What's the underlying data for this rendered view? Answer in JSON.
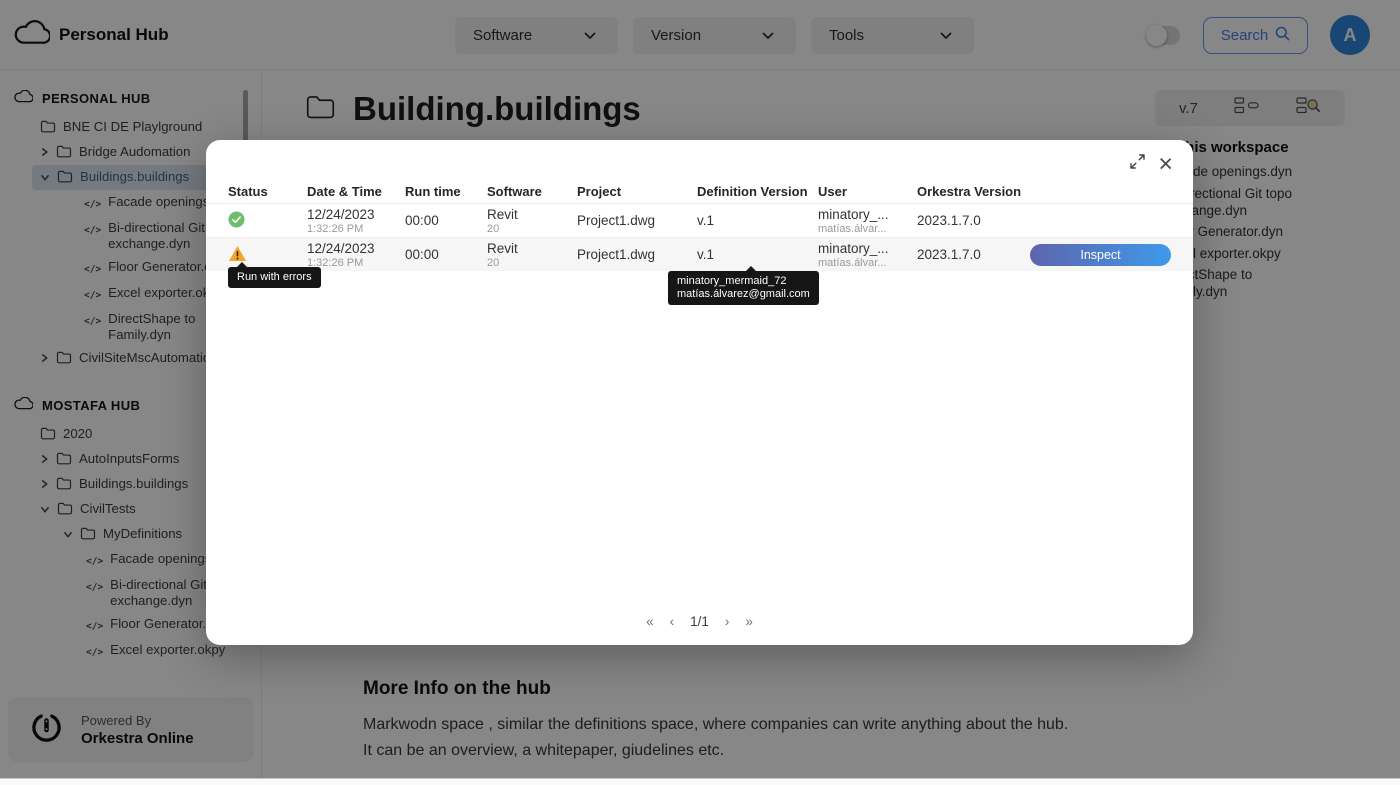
{
  "header": {
    "app_title": "Personal Hub",
    "dropdowns": [
      {
        "label": "Software"
      },
      {
        "label": "Version"
      },
      {
        "label": "Tools"
      }
    ],
    "search_label": "Search",
    "avatar_initial": "A"
  },
  "sidebar": {
    "hubs": [
      {
        "name": "PERSONAL HUB",
        "items": [
          {
            "indent": 1,
            "icon": "folder",
            "label": "BNE CI DE Playlground"
          },
          {
            "indent": 1,
            "chevron": "right",
            "icon": "folder",
            "label": "Bridge Audomation"
          },
          {
            "indent": 1,
            "chevron": "down",
            "icon": "folder",
            "label": "Buildings.buildings",
            "selected": true
          },
          {
            "indent": 2,
            "icon": "code",
            "label": "Facade openings.dyn"
          },
          {
            "indent": 2,
            "icon": "code",
            "label": "Bi-directional Git topo exchange.dyn"
          },
          {
            "indent": 2,
            "icon": "code",
            "label": "Floor Generator.dyn"
          },
          {
            "indent": 2,
            "icon": "code",
            "label": "Excel exporter.okpy"
          },
          {
            "indent": 2,
            "icon": "code",
            "label": "DirectShape to Family.dyn"
          },
          {
            "indent": 1,
            "chevron": "right",
            "icon": "folder",
            "label": "CivilSiteMscAutomation"
          }
        ]
      },
      {
        "name": "MOSTAFA HUB",
        "items": [
          {
            "indent": 1,
            "icon": "folder",
            "label": "2020"
          },
          {
            "indent": 1,
            "chevron": "right",
            "icon": "folder",
            "label": "AutoInputsForms"
          },
          {
            "indent": 1,
            "chevron": "right",
            "icon": "folder",
            "label": "Buildings.buildings"
          },
          {
            "indent": 1,
            "chevron": "down",
            "icon": "folder",
            "label": "CivilTests"
          },
          {
            "indent": 2,
            "chevron": "down",
            "icon": "folder",
            "label": "MyDefinitions"
          },
          {
            "indent": 3,
            "icon": "code",
            "label": "Facade openings.dyn"
          },
          {
            "indent": 3,
            "icon": "code",
            "label": "Bi-directional Git topo exchange.dyn"
          },
          {
            "indent": 3,
            "icon": "code",
            "label": "Floor Generator.dyn"
          },
          {
            "indent": 3,
            "icon": "code",
            "label": "Excel exporter.okpy"
          },
          {
            "indent": 3,
            "icon": "code",
            "label": "DirectShape to Family.dyn"
          }
        ]
      }
    ],
    "footer": {
      "powered_by": "Powered By",
      "brand": "Orkestra Online"
    }
  },
  "main": {
    "page_title": "Building.buildings",
    "toolbar": {
      "version_label": "v.7"
    },
    "workspace_panel": {
      "heading": "Definitions in this workspace",
      "items": [
        "Facade openings.dyn",
        "Bi-directional Git topo exchange.dyn",
        "Floor Generator.dyn",
        "Excel exporter.okpy",
        "DirectShape to Family.dyn"
      ]
    },
    "more_info": {
      "heading": "More Info on the hub",
      "body": "Markwodn space , similar the definitions space, where companies can write anything about the hub. It can be an overview, a whitepaper, giudelines etc."
    }
  },
  "modal": {
    "columns": [
      "Status",
      "Date & Time",
      "Run time",
      "Software",
      "Project",
      "Definition Version",
      "User",
      "Orkestra Version"
    ],
    "rows": [
      {
        "status": "success",
        "date": "12/24/2023",
        "time": "1:32:26 PM",
        "run_time": "00:00",
        "software": "Revit",
        "software_version": "20",
        "project": "Project1.dwg",
        "definition_version": "v.1",
        "user": "minatory_...",
        "user_email": "matías.álvar...",
        "orkestra_version": "2023.1.7.0"
      },
      {
        "status": "warning",
        "date": "12/24/2023",
        "time": "1:32:26 PM",
        "run_time": "00:00",
        "software": "Revit",
        "software_version": "20",
        "project": "Project1.dwg",
        "definition_version": "v.1",
        "user": "minatory_...",
        "user_email": "matías.álvar...",
        "orkestra_version": "2023.1.7.0",
        "action": "Inspect"
      }
    ],
    "tooltips": {
      "status_tooltip": "Run with errors",
      "user_tooltip_name": "minatory_mermaid_72",
      "user_tooltip_email": "matías.álvarez@gmail.com"
    },
    "pagination": {
      "first": "«",
      "prev": "‹",
      "label": "1/1",
      "next": "›",
      "last": "»"
    }
  },
  "colors": {
    "accent_blue": "#2E86DE",
    "success_green": "#6DBE6D",
    "warning_orange": "#F5A52E",
    "inspect_gradient_start": "#5E64AD",
    "inspect_gradient_end": "#3F99EA",
    "selected_item_bg": "#DCE6F2",
    "selected_item_text": "#47618C"
  }
}
